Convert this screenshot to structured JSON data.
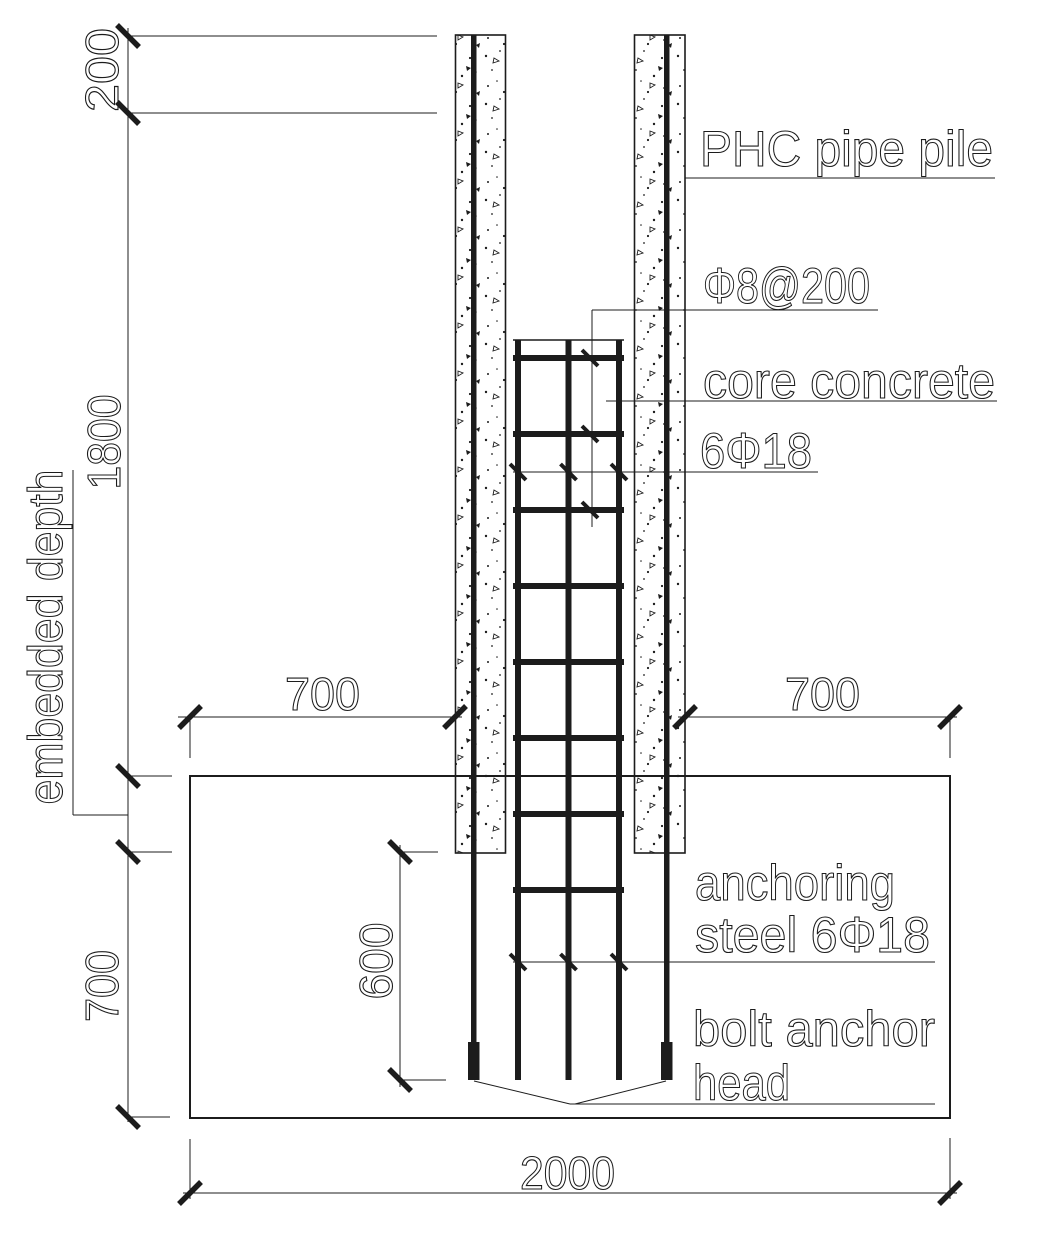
{
  "drawing": {
    "colors": {
      "ink": "#1c1c1c",
      "background": "#ffffff"
    },
    "annotations": {
      "pipe_pile": "PHC pipe pile",
      "stirrups": "Φ8@200",
      "core_concrete": "core concrete",
      "cage_bars": "6Φ18",
      "anchoring_steel_line1": "anchoring",
      "anchoring_steel_line2": "steel 6Φ18",
      "bolt_anchor_line1": "bolt anchor",
      "bolt_anchor_line2": "head",
      "embedded_depth": "embedded depth"
    },
    "dimensions": {
      "pile_top_offset": "200",
      "embedded_length": "1800",
      "left_width": "700",
      "right_width": "700",
      "cap_below_pile_toe": "700",
      "anchor_length": "600",
      "cap_width": "2000"
    }
  }
}
